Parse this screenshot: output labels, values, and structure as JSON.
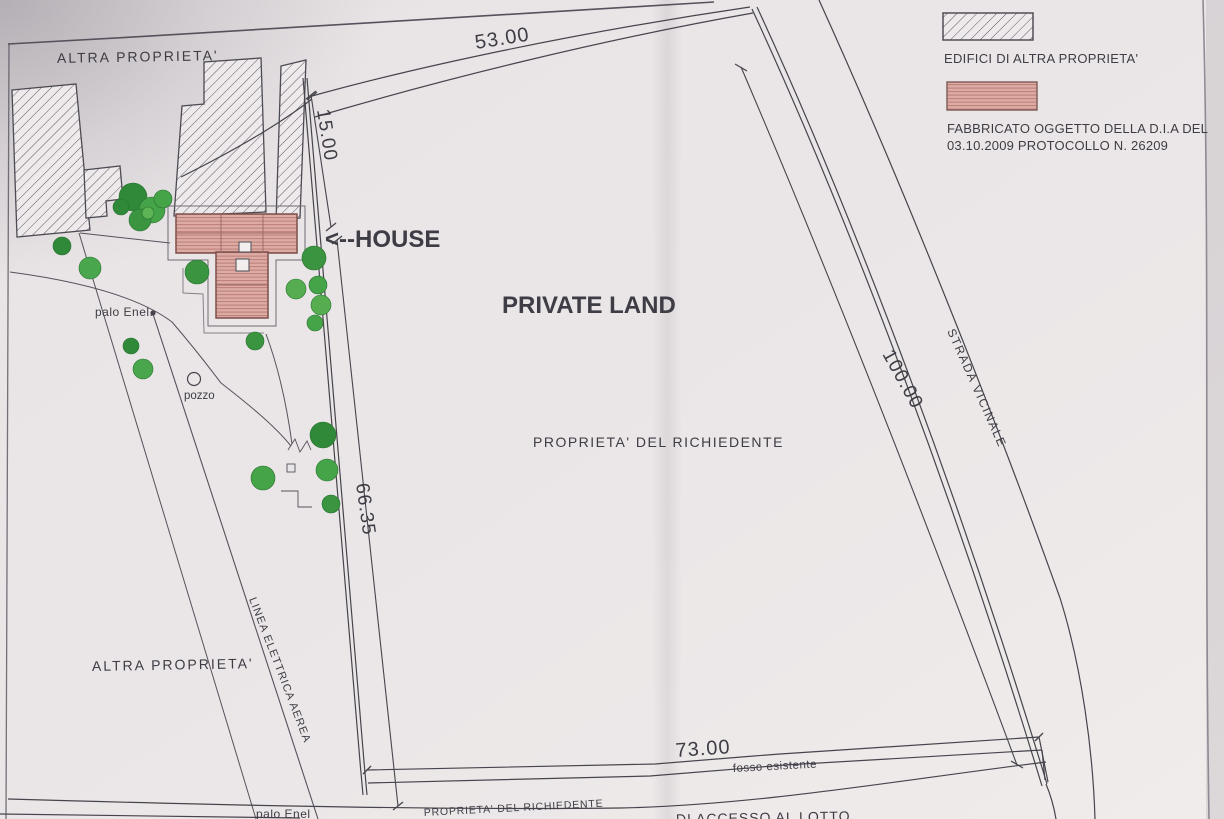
{
  "legend": {
    "edifici_label": "EDIFICI DI ALTRA PROPRIETA'",
    "fabbricato_line1": "FABBRICATO OGGETTO DELLA D.I.A DEL",
    "fabbricato_line2": "03.10.2009 PROTOCOLLO N. 26209"
  },
  "annotations": {
    "house": "<--HOUSE",
    "private_land": "PRIVATE LAND"
  },
  "labels": {
    "altra_proprieta": "ALTRA PROPRIETA'",
    "proprieta_richiedente": "PROPRIETA' DEL RICHIEDENTE",
    "strada_vicinale": "STRADA VICINALE",
    "linea_elettrica": "LINEA ELETTRICA AEREA",
    "fosso_esistente": "fosso esistente",
    "palo_enel": "palo Enel.",
    "palo_enel_bottom": "palo Enel",
    "pozzo": "pozzo",
    "accesso_partial": "DI ACCESSO AL LOTTO"
  },
  "dimensions": {
    "top": "53.00",
    "left_top": "15.00",
    "left": "66.35",
    "right": "100.00",
    "bottom": "73.00"
  },
  "colors": {
    "annotation_red": "#e81511",
    "strada_text": "#a4414b",
    "tree_green": "#3a9440",
    "building_pink": "#dcaba4",
    "pink_hatch": "#bd7d76",
    "ink": "#46444c",
    "paper": "#e9e4e6"
  }
}
